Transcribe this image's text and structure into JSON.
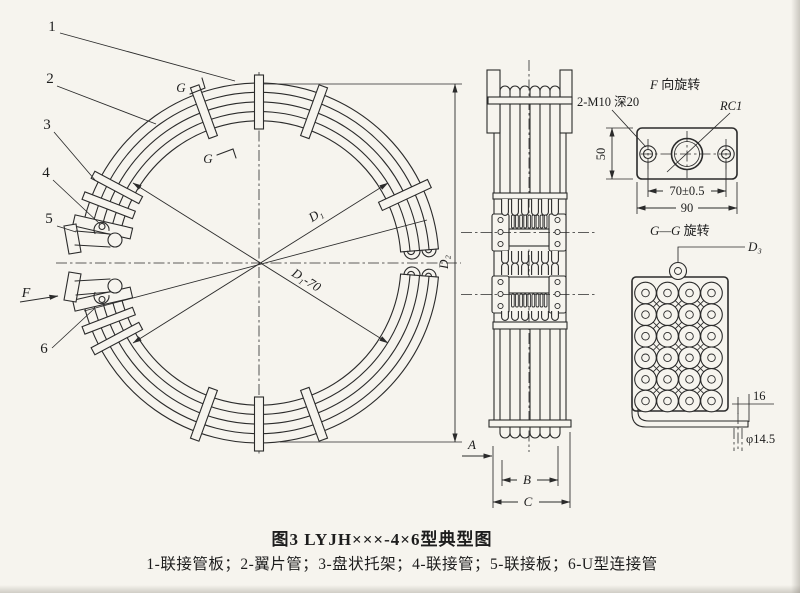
{
  "page": {
    "paper_color": "#f6f4ee",
    "ink_color": "#2b2b2b"
  },
  "caption": {
    "title": "图3 LYJH×××-4×6型典型图",
    "parts": "1-联接管板；2-翼片管；3-盘状托架；4-联接管；5-联接板；6-U型连接管"
  },
  "plan_view": {
    "labels": {
      "n1": "1",
      "n2": "2",
      "n3": "3",
      "n4": "4",
      "n5": "5",
      "n6": "6"
    },
    "view_f": "F",
    "g_top": "G",
    "g_bottom": "G",
    "dim_d1": "D₁",
    "dim_d1_70": "D₁-70",
    "dim_d2": "D₂"
  },
  "side_view": {
    "dim_a": "A",
    "dim_b": "B",
    "dim_c": "C"
  },
  "detail_f": {
    "title_f": "F",
    "title_rest": " 向旋转",
    "note_thread": "2-M10 深20",
    "note_rc": "RC1",
    "dim_height": "50",
    "dim_holes": "70±0.5",
    "dim_width": "90"
  },
  "detail_gg": {
    "title_g": "G—G",
    "title_rest": " 旋转",
    "dim_d3": "D₃",
    "dim_flange": "16",
    "dim_hole": "φ14.5"
  }
}
